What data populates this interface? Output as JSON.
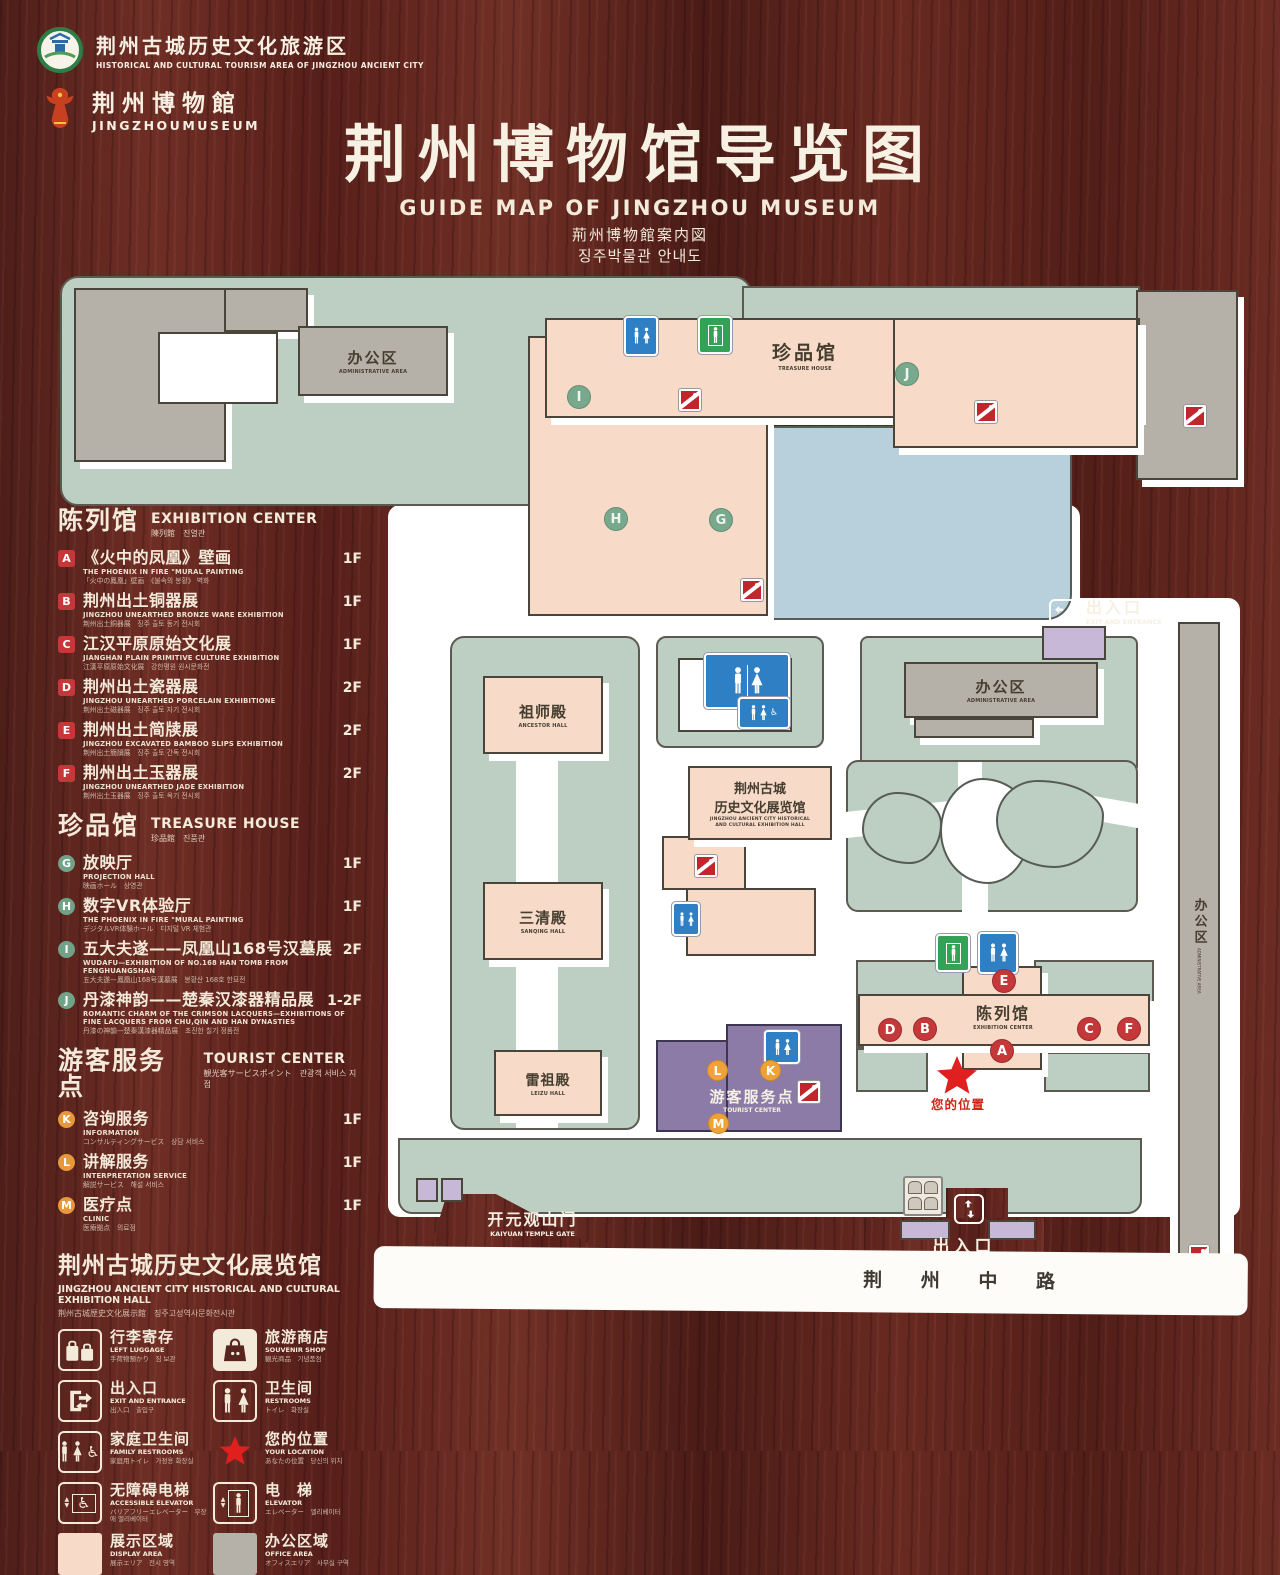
{
  "header": {
    "logo_tourism": {
      "zh": "荆州古城历史文化旅游区",
      "en": "HISTORICAL AND CULTURAL TOURISM AREA OF JINGZHOU ANCIENT CITY"
    },
    "logo_museum": {
      "zh": "荆州博物館",
      "en": "JINGZHOUMUSEUM"
    },
    "title": "荆州博物馆导览图",
    "subtitle_en": "GUIDE MAP OF JINGZHOU MUSEUM",
    "subtitle_ja": "荊州博物館案内図",
    "subtitle_ko": "징주박물관 안내도"
  },
  "sections": {
    "exhibition": {
      "zh": "陈列馆",
      "en": "EXHIBITION CENTER",
      "sub": "陳列館　진열관",
      "items": [
        {
          "letter": "A",
          "zh": "《火中的凤凰》壁画",
          "en": "THE PHOENIX IN FIRE \"MURAL PAINTING",
          "sub": "「火中の鳳凰」壁画　《불속의 봉황》 벽화",
          "floor": "1F"
        },
        {
          "letter": "B",
          "zh": "荆州出土铜器展",
          "en": "JINGZHOU UNEARTHED BRONZE WARE EXHIBITION",
          "sub": "荆州出土銅器展　징주 출토 동기 전시회",
          "floor": "1F"
        },
        {
          "letter": "C",
          "zh": "江汉平原原始文化展",
          "en": "JIANGHAN PLAIN PRIMITIVE CULTURE EXHIBITION",
          "sub": "江漢平原原始文化展　강한평원 원시문화전",
          "floor": "1F"
        },
        {
          "letter": "D",
          "zh": "荆州出土瓷器展",
          "en": "JINGZHOU UNEARTHED PORCELAIN EXHIBITIONE",
          "sub": "荆州出土磁器展　징주 출토 자기 전시회",
          "floor": "2F"
        },
        {
          "letter": "E",
          "zh": "荆州出土简牍展",
          "en": "JINGZHOU EXCAVATED BAMBOO SLIPS EXHIBITION",
          "sub": "荆州出土簡牘展　징주 출토 간독 전시회",
          "floor": "2F"
        },
        {
          "letter": "F",
          "zh": "荆州出土玉器展",
          "en": "JINGZHOU UNEARTHED JADE EXHIBITION",
          "sub": "荆州出土玉器展　징주 출토 옥기 전시회",
          "floor": "2F"
        }
      ]
    },
    "treasure": {
      "zh": "珍品馆",
      "en": "TREASURE HOUSE",
      "sub": "珍品館　진품관",
      "items": [
        {
          "letter": "G",
          "zh": "放映厅",
          "en": "PROJECTION HALL",
          "sub": "映画ホール　상영관",
          "floor": "1F"
        },
        {
          "letter": "H",
          "zh": "数字VR体验厅",
          "en": "THE PHOENIX IN FIRE \"MURAL PAINTING",
          "sub": "デジタルVR体験ホール　디지털 VR 체험관",
          "floor": "1F"
        },
        {
          "letter": "I",
          "zh": "五大夫遂——凤凰山168号汉墓展",
          "en": "WUDAFU—EXHIBITION OF NO.168 HAN TOMB FROM FENGHUANGSHAN",
          "sub": "五大夫遂—鳳凰山168号漢墓展　봉황산 168호 한묘전",
          "floor": "2F"
        },
        {
          "letter": "J",
          "zh": "丹漆神韵——楚秦汉漆器精品展",
          "en": "ROMANTIC CHARM OF THE CRIMSON LACQUERS—EXHIBITIONS OF FINE LACQUERS FROM CHU,QIN AND HAN DYNASTIES",
          "sub": "丹漆の神韻—楚秦漢漆器精品展　초진한 칠기 정품전",
          "floor": "1-2F"
        }
      ]
    },
    "tourist": {
      "zh": "游客服务点",
      "en": "TOURIST CENTER",
      "sub": "観光客サービスポイント　관광객 서비스 지점",
      "items": [
        {
          "letter": "K",
          "zh": "咨询服务",
          "en": "INFORMATION",
          "sub": "コンサルティングサービス　상담 서비스",
          "floor": "1F"
        },
        {
          "letter": "L",
          "zh": "讲解服务",
          "en": "INTERPRETATION SERVICE",
          "sub": "解説サービス　해설 서비스",
          "floor": "1F"
        },
        {
          "letter": "M",
          "zh": "医疗点",
          "en": "CLINIC",
          "sub": "医療拠点　의료점",
          "floor": "1F"
        }
      ]
    }
  },
  "hall_heading": {
    "zh": "荆州古城历史文化展览馆",
    "en": "JINGZHOU ANCIENT CITY HISTORICAL AND CULTURAL EXHIBITION HALL",
    "sub": "荆州古城歴史文化展示館　징주고성역사문화전시관"
  },
  "legend": {
    "items": [
      {
        "zh": "行李寄存",
        "en": "LEFT LUGGAGE",
        "sub": "手荷物預かり　짐 보관",
        "icon": "luggage-icon"
      },
      {
        "zh": "旅游商店",
        "en": "SOUVENIR SHOP",
        "sub": "観光商品　기념품점",
        "icon": "souvenir-shop-icon"
      },
      {
        "zh": "出入口",
        "en": "EXIT AND ENTRANCE",
        "sub": "出入口　출입구",
        "icon": "exit-entrance-icon"
      },
      {
        "zh": "卫生间",
        "en": "RESTROOMS",
        "sub": "トイレ　화장실",
        "icon": "restroom-icon"
      },
      {
        "zh": "家庭卫生间",
        "en": "FAMILY RESTROOMS",
        "sub": "家庭用トイレ　가정용 화장실",
        "icon": "family-restroom-icon"
      },
      {
        "zh": "您的位置",
        "en": "YOUR LOCATION",
        "sub": "あなたの位置　당신의 위치",
        "icon": "location-star-icon"
      },
      {
        "zh": "无障碍电梯",
        "en": "ACCESSIBLE ELEVATOR",
        "sub": "バリアフリーエレベーター　무장애 엘리베이터",
        "icon": "accessible-elevator-icon"
      },
      {
        "zh": "电　梯",
        "en": "ELEVATOR",
        "sub": "エレベーター　엘리베이터",
        "icon": "elevator-icon"
      },
      {
        "zh": "展示区域",
        "en": "DISPLAY AREA",
        "sub": "展示エリア　전시 영역",
        "icon": "display-area-swatch"
      },
      {
        "zh": "办公区域",
        "en": "OFFICE AREA",
        "sub": "オフィスエリア　사무실 구역",
        "icon": "office-area-swatch"
      }
    ]
  },
  "map": {
    "labels": {
      "admin_top_zh": "办公区",
      "admin_top_en": "ADMINISTRATIVE AREA",
      "treasure_zh": "珍品馆",
      "treasure_en": "TREASURE HOUSE",
      "exit_top_zh": "出入口",
      "exit_top_en": "EXIT AND ENTRANCE",
      "admin_mid_zh": "办公区",
      "admin_mid_en": "ADMINISTRATIVE AREA",
      "ancestor_zh": "祖师殿",
      "ancestor_en": "ANCESTOR HALL",
      "hall_zh1": "荆州古城",
      "hall_zh2": "历史文化展览馆",
      "hall_en1": "JINGZHOU ANCIENT CITY HISTORICAL",
      "hall_en2": "AND CULTURAL EXHIBITION HALL",
      "sanqing_zh": "三清殿",
      "sanqing_en": "SANQING HALL",
      "leizu_zh": "雷祖殿",
      "leizu_en": "LEIZU HALL",
      "tourist_zh": "游客服务点",
      "tourist_en": "TOURIST CENTER",
      "exhibition_zh": "陈列馆",
      "exhibition_en": "EXHIBITION CENTER",
      "your_location": "您的位置",
      "gate_zh": "开元观山门",
      "gate_en": "KAIYUAN TEMPLE GATE",
      "exit_bottom_zh": "出入口",
      "exit_bottom_en": "EXIT AND ENTRANCE",
      "road": "荆 州 中 路",
      "admin_right_zh": "办公区",
      "admin_right_en": "ADMINISTRATIVE AREA"
    },
    "markers_green": [
      {
        "letter": "I",
        "x": 567,
        "y": 385
      },
      {
        "letter": "J",
        "x": 895,
        "y": 362
      },
      {
        "letter": "H",
        "x": 604,
        "y": 507
      },
      {
        "letter": "G",
        "x": 709,
        "y": 508
      }
    ],
    "markers_red": [
      {
        "letter": "E",
        "x": 992,
        "y": 969
      },
      {
        "letter": "D",
        "x": 878,
        "y": 1018
      },
      {
        "letter": "B",
        "x": 913,
        "y": 1017
      },
      {
        "letter": "C",
        "x": 1077,
        "y": 1017
      },
      {
        "letter": "F",
        "x": 1117,
        "y": 1017
      },
      {
        "letter": "A",
        "x": 990,
        "y": 1039
      }
    ],
    "markers_orange": [
      {
        "letter": "L",
        "x": 707,
        "y": 1060
      },
      {
        "letter": "K",
        "x": 760,
        "y": 1060
      },
      {
        "letter": "M",
        "x": 708,
        "y": 1113
      }
    ]
  },
  "colors": {
    "display_area": "#f7dac7",
    "office_area": "#b6b1a8",
    "ground_green": "#bccfc2",
    "lake_blue": "#b8cfdc",
    "tourist_purple": "#8b7ba6",
    "marker_red": "#c5383a",
    "marker_green": "#79a98d",
    "marker_orange": "#f0a23a",
    "star_red": "#e01f1f",
    "restroom_blue": "#2f7fc4",
    "elevator_green": "#33a257",
    "escalator_red": "#c0272d"
  }
}
